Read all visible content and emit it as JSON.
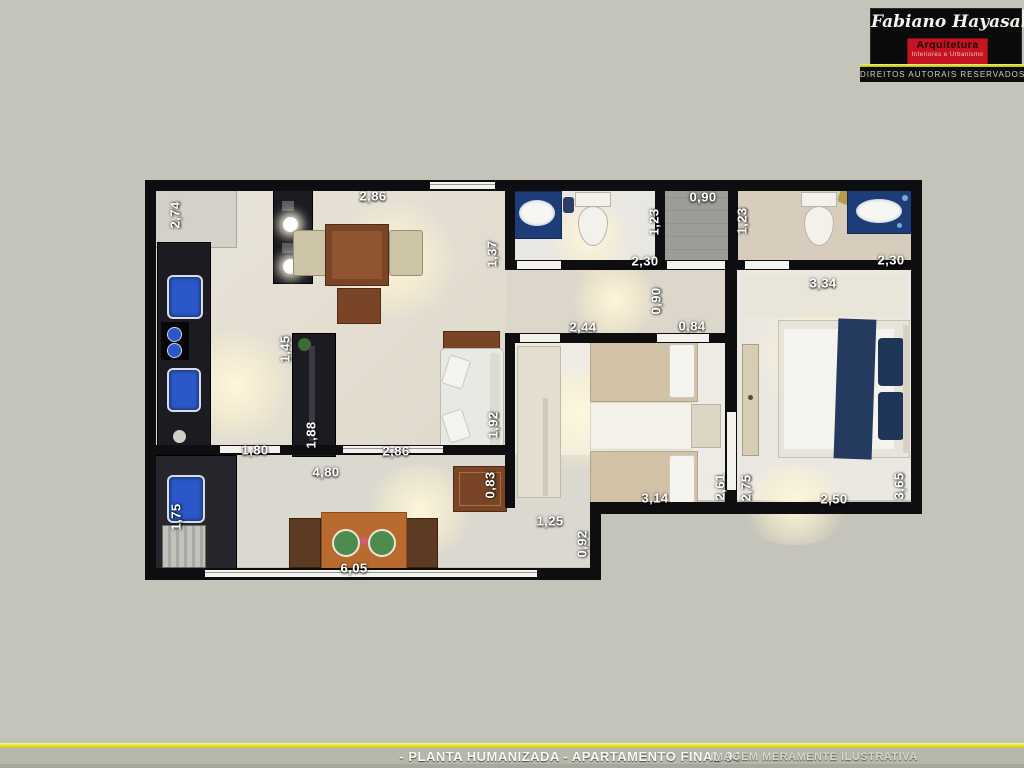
{
  "logo": {
    "name": "Fabiano Hayasaki",
    "field": "Arquitetura",
    "tagline": "Interiores e Urbanismo",
    "rights": "DIREITOS AUTORAIS RESERVADOS",
    "colors": {
      "box": "#0b0b0b",
      "accent": "#c41321",
      "line": "#d9d92e"
    }
  },
  "footer": {
    "title": "- PLANTA HUMANIZADA - APARTAMENTO FINAL 04",
    "note": "IMAGEM MERAMENTE ILUSTRATIVA",
    "line_color": "#e2e236"
  },
  "floor_plan": {
    "unit": "m",
    "dimensions": [
      {
        "text": "2,74",
        "x": 175,
        "y": 215,
        "vertical": true
      },
      {
        "text": "2,86",
        "x": 373,
        "y": 196,
        "vertical": false
      },
      {
        "text": "0,90",
        "x": 703,
        "y": 197,
        "vertical": false
      },
      {
        "text": "1,23",
        "x": 654,
        "y": 222,
        "vertical": true
      },
      {
        "text": "1,23",
        "x": 742,
        "y": 221,
        "vertical": true
      },
      {
        "text": "1,37",
        "x": 492,
        "y": 254,
        "vertical": true
      },
      {
        "text": "2,30",
        "x": 645,
        "y": 261,
        "vertical": false
      },
      {
        "text": "2,30",
        "x": 891,
        "y": 260,
        "vertical": false
      },
      {
        "text": "3,34",
        "x": 823,
        "y": 283,
        "vertical": false
      },
      {
        "text": "0,90",
        "x": 656,
        "y": 301,
        "vertical": true
      },
      {
        "text": "2,44",
        "x": 583,
        "y": 327,
        "vertical": false
      },
      {
        "text": "0,84",
        "x": 692,
        "y": 326,
        "vertical": false
      },
      {
        "text": "1,45",
        "x": 285,
        "y": 349,
        "vertical": true
      },
      {
        "text": "1,92",
        "x": 493,
        "y": 425,
        "vertical": true
      },
      {
        "text": "1,88",
        "x": 311,
        "y": 435,
        "vertical": true
      },
      {
        "text": "1,80",
        "x": 255,
        "y": 450,
        "vertical": false
      },
      {
        "text": "2,86",
        "x": 396,
        "y": 451,
        "vertical": false
      },
      {
        "text": "4,80",
        "x": 326,
        "y": 472,
        "vertical": false
      },
      {
        "text": "0,83",
        "x": 490,
        "y": 485,
        "vertical": true
      },
      {
        "text": "2,61",
        "x": 720,
        "y": 487,
        "vertical": true
      },
      {
        "text": "2,75",
        "x": 746,
        "y": 488,
        "vertical": true
      },
      {
        "text": "3,65",
        "x": 899,
        "y": 486,
        "vertical": true
      },
      {
        "text": "3,14",
        "x": 655,
        "y": 498,
        "vertical": false
      },
      {
        "text": "2,50",
        "x": 834,
        "y": 499,
        "vertical": false
      },
      {
        "text": "1,25",
        "x": 550,
        "y": 521,
        "vertical": false
      },
      {
        "text": "0,92",
        "x": 582,
        "y": 544,
        "vertical": true
      },
      {
        "text": "1,75",
        "x": 176,
        "y": 517,
        "vertical": true
      },
      {
        "text": "6,05",
        "x": 354,
        "y": 568,
        "vertical": false
      }
    ]
  }
}
